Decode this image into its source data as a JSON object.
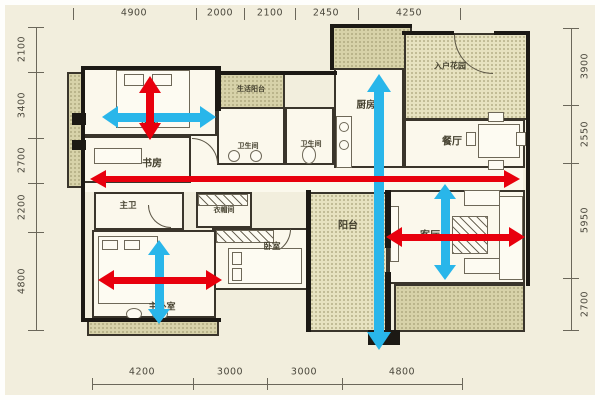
{
  "dims": {
    "top": [
      "4900",
      "2000",
      "2100",
      "2450",
      "4250"
    ],
    "left": [
      "2100",
      "3400",
      "2700",
      "2200",
      "4800"
    ],
    "right": [
      "3900",
      "2550",
      "5950",
      "2700"
    ],
    "bottom": [
      "4200",
      "3000",
      "3000",
      "4800"
    ]
  },
  "rooms": {
    "bedroom2": "卧室",
    "study": "书房",
    "service_balcony": "生活阳台",
    "bath1": "卫生间",
    "bath2": "卫生间",
    "kitchen": "厨房",
    "entry_garden": "入户花园",
    "dining": "餐厅",
    "master_bath": "主卫",
    "cloakroom": "衣帽间",
    "bedroom3": "卧室",
    "master_bedroom": "主卧室",
    "balcony": "阳台",
    "living": "客厅"
  },
  "arrows": {
    "red_color": "#e8000d",
    "cyan_color": "#29b6ea",
    "red": [
      "bedroom2-vertical",
      "corridor-horizontal-main",
      "master-bedroom-horizontal",
      "living-horizontal"
    ],
    "cyan": [
      "bedroom2-horizontal",
      "kitchen-to-balcony-vertical-main",
      "master-bedroom-vertical",
      "living-vertical"
    ]
  }
}
